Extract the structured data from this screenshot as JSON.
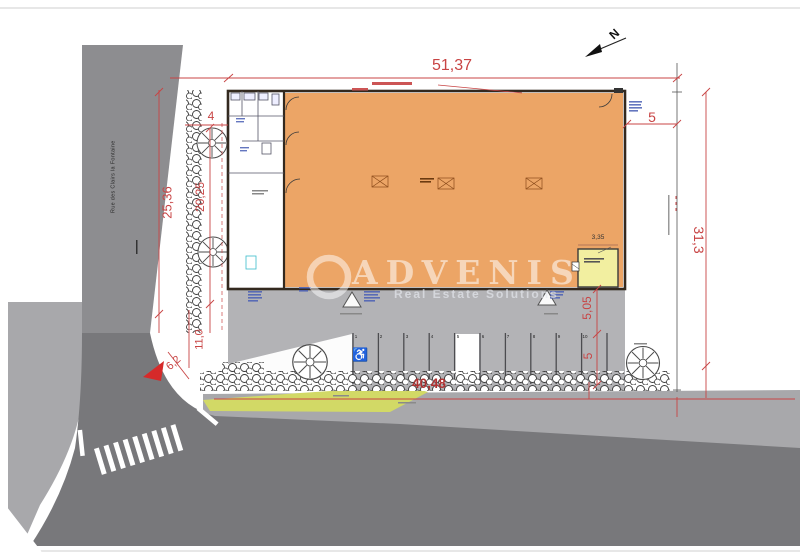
{
  "plan": {
    "street_name": "Rue des Clairs la Fontaine",
    "north_label": "N",
    "watermark": {
      "brand": "ADVENIS",
      "tagline": "Real Estate Solutions"
    },
    "dimensions": {
      "building_width": "51,37",
      "parcel_right": "31,3",
      "right_setback": "5",
      "left_frontage": "25,36",
      "landscape_strip": "20,25",
      "hedge_width": "4",
      "access_width": "11,0",
      "curb_radius": "6,2",
      "apron_depth": "5,05",
      "stall_depth": "5",
      "frontage_bottom": "40,48",
      "local_width": "3,35"
    },
    "parking": {
      "stalls": [
        "1",
        "2",
        "3",
        "4",
        "5",
        "6",
        "7",
        "8",
        "9",
        "10"
      ],
      "accessible_icon": "♿"
    },
    "colors": {
      "building_fill": "#ECA566",
      "local_fill": "#F2EFA0",
      "grass": "#D2D966",
      "road_dark": "#78787B",
      "road_medium": "#8D8D90",
      "sidewalk": "#A8A8AB",
      "apron": "#B3B3B6",
      "dimension_red": "#C84444",
      "annotation_blue": "#4A5FB5"
    }
  }
}
